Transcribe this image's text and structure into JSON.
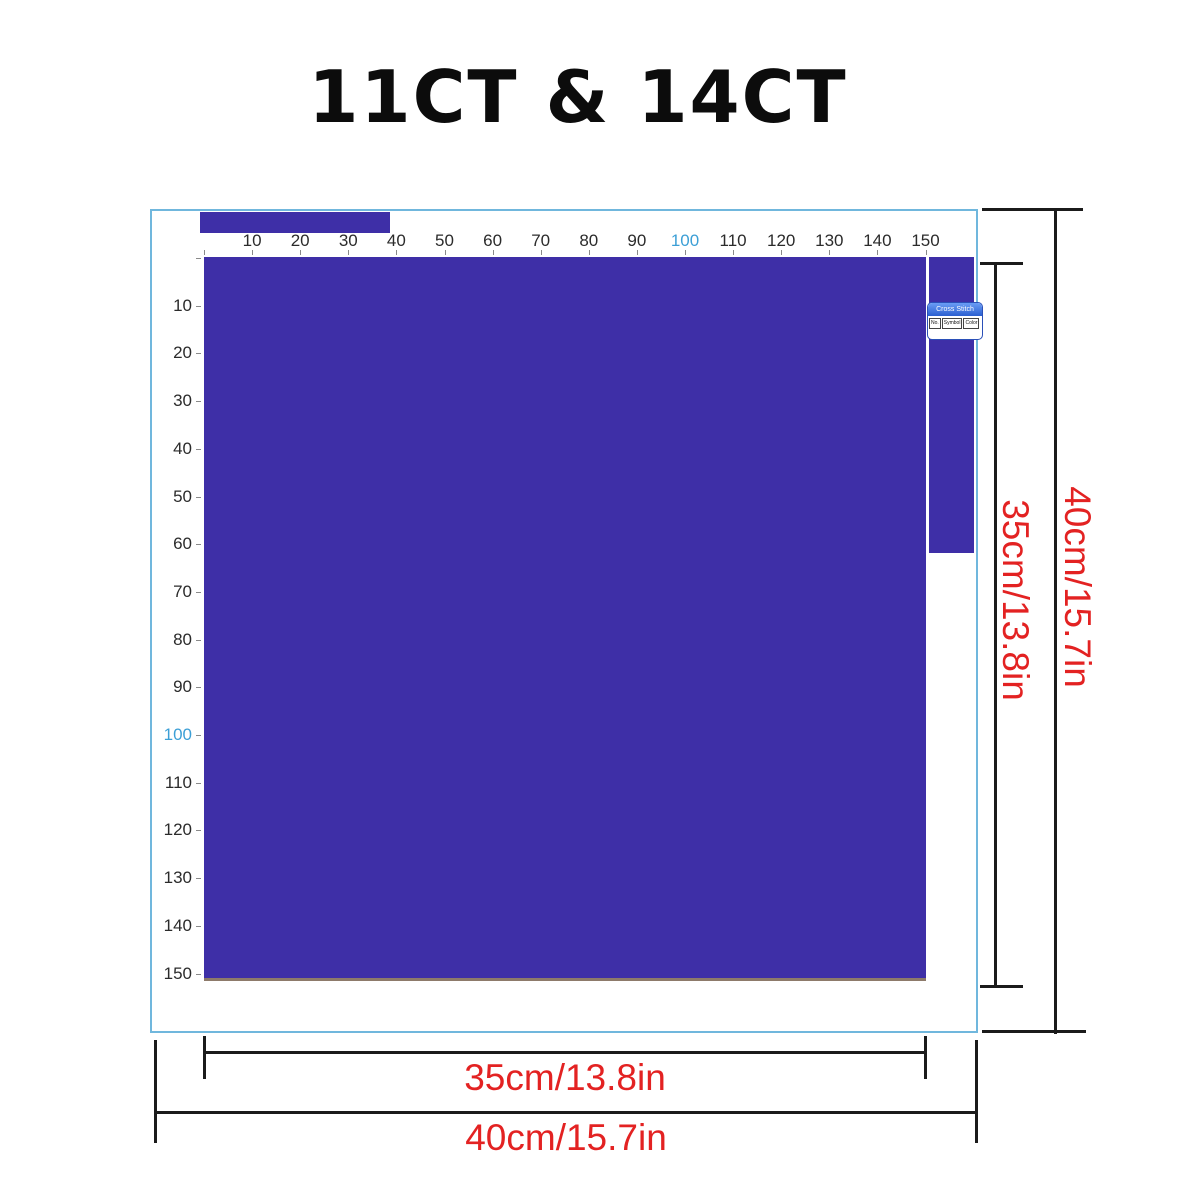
{
  "title": "11CT & 14CT",
  "ruler": {
    "top_labels": [
      "10",
      "20",
      "30",
      "40",
      "50",
      "60",
      "70",
      "80",
      "90",
      "100",
      "110",
      "120",
      "130",
      "140",
      "150"
    ],
    "left_labels": [
      "10",
      "20",
      "30",
      "40",
      "50",
      "60",
      "70",
      "80",
      "90",
      "100",
      "110",
      "120",
      "130",
      "140",
      "150"
    ],
    "highlight_value": "100",
    "highlight_color": "#3c9fd6"
  },
  "pattern": {
    "fill_color": "#3e2fa7",
    "border_color": "#70b7dd"
  },
  "widget": {
    "title": "Cross Stitch",
    "columns": [
      "No.",
      "Symbol",
      "Color"
    ]
  },
  "dimensions": {
    "accent_color": "#e32222",
    "height_inner": "35cm/13.8in",
    "height_outer": "40cm/15.7in",
    "width_inner": "35cm/13.8in",
    "width_outer": "40cm/15.7in"
  }
}
